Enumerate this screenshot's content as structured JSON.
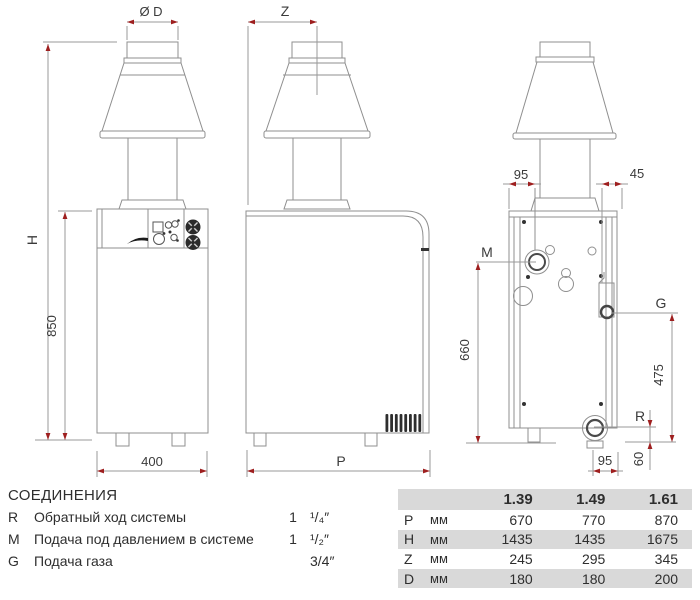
{
  "drawing": {
    "front": {
      "diameter_label": "Ø D",
      "height_label": "H",
      "body_height": "850",
      "width": "400"
    },
    "side": {
      "flue_offset_label": "Z",
      "depth_label": "P"
    },
    "rear": {
      "m_offset": "95",
      "g_offset": "45",
      "m_label": "M",
      "g_label": "G",
      "r_label": "R",
      "m_height": "660",
      "g_height": "475",
      "r_offset": "95",
      "r_height": "60"
    }
  },
  "legend": {
    "title": "СОЕДИНЕНИЯ",
    "items": [
      {
        "key": "R",
        "label": "Обратный ход системы",
        "whole": "1",
        "fraction": "¹/₄″"
      },
      {
        "key": "M",
        "label": "Подача под давлением в системе",
        "whole": "1",
        "fraction": "¹/₂″"
      },
      {
        "key": "G",
        "label": "Подача газа",
        "whole": "",
        "fraction": "3/4″"
      }
    ]
  },
  "spec_table": {
    "models": [
      "1.39",
      "1.49",
      "1.61"
    ],
    "rows": [
      {
        "param": "P",
        "unit": "мм",
        "values": [
          "670",
          "770",
          "870"
        ]
      },
      {
        "param": "H",
        "unit": "мм",
        "values": [
          "1435",
          "1435",
          "1675"
        ]
      },
      {
        "param": "Z",
        "unit": "мм",
        "values": [
          "245",
          "295",
          "345"
        ]
      },
      {
        "param": "D",
        "unit": "мм",
        "values": [
          "180",
          "180",
          "200"
        ]
      }
    ]
  },
  "colors": {
    "line": "#8f8f8f",
    "dark": "#2e2e2e",
    "arrow": "#9e1f1f",
    "stripe": "#d9d9d9"
  }
}
